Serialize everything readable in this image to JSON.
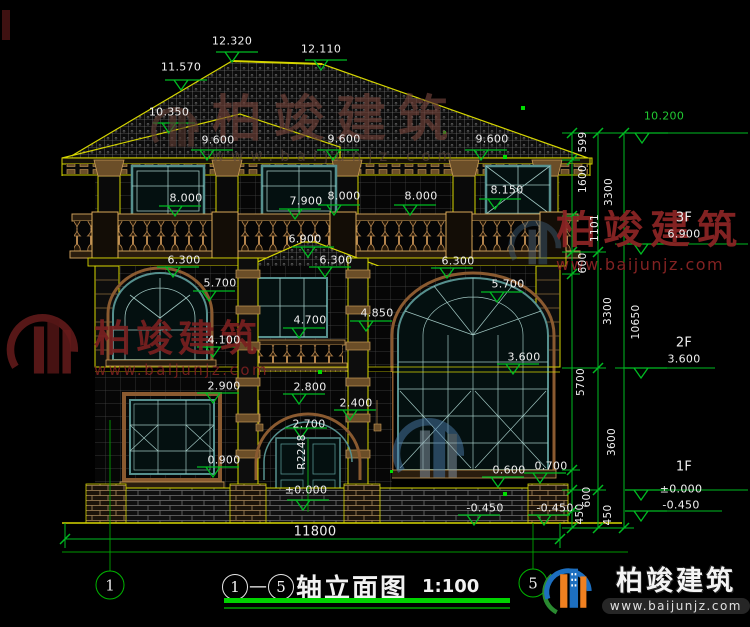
{
  "title": {
    "axis_start": "1",
    "separator": "—",
    "axis_end": "5",
    "name": "轴立面图",
    "scale": "1:100"
  },
  "watermarks": {
    "top": {
      "text": "柏竣建筑",
      "url": "www.baijunjz.com"
    },
    "left": {
      "text": "柏竣建筑",
      "url": "www.baijunjz.com"
    },
    "right": {
      "text": "柏竣建筑",
      "url": "www.baijunjz.com"
    },
    "brand": {
      "text": "柏竣建筑",
      "url": "www.baijunjz.com"
    }
  },
  "axis_bubbles": [
    {
      "label": "1",
      "x": 110,
      "y": 585
    },
    {
      "label": "5",
      "x": 533,
      "y": 583
    }
  ],
  "colors": {
    "line_yellow": "#d6d600",
    "dim_green": "#00bb22",
    "text_white": "#efefef",
    "window_teal": "#56908e",
    "wood_tan": "#c79a57",
    "watermark_red": "#7a2020",
    "brand_blue": "#1d6fc0",
    "brand_orange": "#f08020"
  },
  "annotations": [
    {
      "t": "12.320",
      "x": 232,
      "y": 41
    },
    {
      "t": "12.110",
      "x": 321,
      "y": 49
    },
    {
      "t": "11.570",
      "x": 181,
      "y": 67
    },
    {
      "t": "10.350",
      "x": 169,
      "y": 112
    },
    {
      "t": "9.600",
      "x": 218,
      "y": 140
    },
    {
      "t": "9.600",
      "x": 344,
      "y": 139
    },
    {
      "t": "9.600",
      "x": 492,
      "y": 139
    },
    {
      "t": "8.000",
      "x": 186,
      "y": 198
    },
    {
      "t": "7.900",
      "x": 306,
      "y": 201
    },
    {
      "t": "8.000",
      "x": 344,
      "y": 196
    },
    {
      "t": "8.000",
      "x": 421,
      "y": 196
    },
    {
      "t": "8.150",
      "x": 507,
      "y": 190
    },
    {
      "t": "6.900",
      "x": 305,
      "y": 239
    },
    {
      "t": "6.300",
      "x": 184,
      "y": 260
    },
    {
      "t": "6.300",
      "x": 336,
      "y": 260
    },
    {
      "t": "6.300",
      "x": 458,
      "y": 261
    },
    {
      "t": "5.700",
      "x": 220,
      "y": 283
    },
    {
      "t": "5.700",
      "x": 508,
      "y": 284
    },
    {
      "t": "4.850",
      "x": 377,
      "y": 313
    },
    {
      "t": "4.700",
      "x": 310,
      "y": 320
    },
    {
      "t": "4.100",
      "x": 224,
      "y": 340
    },
    {
      "t": "3.600",
      "x": 524,
      "y": 357
    },
    {
      "t": "2.900",
      "x": 224,
      "y": 386
    },
    {
      "t": "2.800",
      "x": 310,
      "y": 387
    },
    {
      "t": "2.700",
      "x": 309,
      "y": 424
    },
    {
      "t": "2.400",
      "x": 356,
      "y": 403
    },
    {
      "t": "R2248",
      "x": 302,
      "y": 452,
      "r": 1
    },
    {
      "t": "0.900",
      "x": 224,
      "y": 460
    },
    {
      "t": "0.600",
      "x": 509,
      "y": 470
    },
    {
      "t": "0.700",
      "x": 551,
      "y": 466
    },
    {
      "t": "±0.000",
      "x": 306,
      "y": 490
    },
    {
      "t": "-0.450",
      "x": 485,
      "y": 508
    },
    {
      "t": "-0.450",
      "x": 555,
      "y": 508
    },
    {
      "t": "11800",
      "x": 315,
      "y": 532,
      "big": 1
    },
    {
      "t": "10.200",
      "x": 664,
      "y": 116,
      "g": 1
    },
    {
      "t": "3F",
      "x": 684,
      "y": 218,
      "big": 1
    },
    {
      "t": "6.900",
      "x": 684,
      "y": 234
    },
    {
      "t": "2F",
      "x": 684,
      "y": 343,
      "big": 1
    },
    {
      "t": "3.600",
      "x": 684,
      "y": 359
    },
    {
      "t": "1F",
      "x": 684,
      "y": 467,
      "big": 1
    },
    {
      "t": "±0.000",
      "x": 681,
      "y": 489
    },
    {
      "t": "-0.450",
      "x": 681,
      "y": 505
    },
    {
      "t": "599",
      "x": 583,
      "y": 142,
      "r": 1
    },
    {
      "t": "1600",
      "x": 583,
      "y": 179,
      "r": 1
    },
    {
      "t": "3300",
      "x": 609,
      "y": 192,
      "r": 1
    },
    {
      "t": "1101",
      "x": 595,
      "y": 228,
      "r": 1
    },
    {
      "t": "600",
      "x": 583,
      "y": 263,
      "r": 1
    },
    {
      "t": "3300",
      "x": 608,
      "y": 311,
      "r": 1
    },
    {
      "t": "10650",
      "x": 636,
      "y": 322,
      "r": 1
    },
    {
      "t": "5700",
      "x": 581,
      "y": 382,
      "r": 1
    },
    {
      "t": "3600",
      "x": 612,
      "y": 442,
      "r": 1
    },
    {
      "t": "600",
      "x": 587,
      "y": 497,
      "r": 1
    },
    {
      "t": "450",
      "x": 580,
      "y": 514,
      "r": 1
    },
    {
      "t": "450",
      "x": 608,
      "y": 515,
      "r": 1
    }
  ],
  "markers": [
    [
      232,
      62
    ],
    [
      321,
      70
    ],
    [
      181,
      90
    ],
    [
      169,
      133
    ],
    [
      207,
      160
    ],
    [
      333,
      160
    ],
    [
      481,
      160
    ],
    [
      175,
      216
    ],
    [
      295,
      219
    ],
    [
      334,
      215
    ],
    [
      410,
      215
    ],
    [
      495,
      209
    ],
    [
      308,
      257
    ],
    [
      173,
      277
    ],
    [
      325,
      277
    ],
    [
      447,
      278
    ],
    [
      209,
      301
    ],
    [
      497,
      302
    ],
    [
      366,
      331
    ],
    [
      299,
      338
    ],
    [
      213,
      357
    ],
    [
      513,
      374
    ],
    [
      213,
      403
    ],
    [
      299,
      404
    ],
    [
      350,
      420
    ],
    [
      301,
      438
    ],
    [
      213,
      477
    ],
    [
      498,
      487
    ],
    [
      540,
      483
    ],
    [
      303,
      510
    ],
    [
      474,
      525
    ],
    [
      544,
      525
    ],
    [
      642,
      143
    ],
    [
      641,
      254
    ],
    [
      641,
      378
    ],
    [
      641,
      500
    ],
    [
      641,
      521
    ]
  ]
}
